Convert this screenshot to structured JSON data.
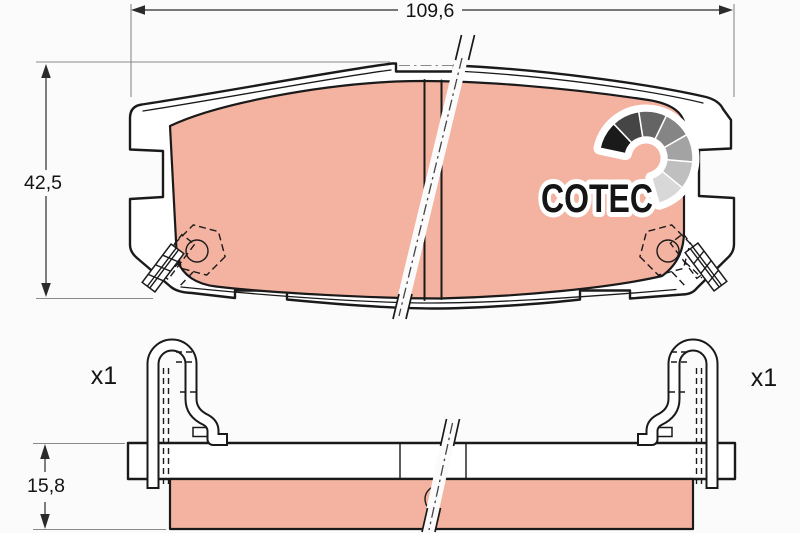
{
  "page": {
    "background": "#fbfbfb"
  },
  "drawing": {
    "type": "brake-pad-technical-drawing",
    "logo": {
      "text": "COTEC",
      "fan_colors": [
        "#1a1a1a",
        "#454545",
        "#646464",
        "#858585",
        "#a3a3a3",
        "#bfbfbf",
        "#d8d8d8"
      ]
    },
    "dimensions": {
      "width": "109,6",
      "height": "42,5",
      "thickness": "15,8"
    },
    "quantity_labels": {
      "left": "x1",
      "right": "x1"
    },
    "colors": {
      "friction_material": "#f4b3a0",
      "outline": "#1a1a1a",
      "dimension_line": "#2b2b2b",
      "extension_line": "#8a8a8a",
      "fill_white": "#ffffff"
    }
  }
}
